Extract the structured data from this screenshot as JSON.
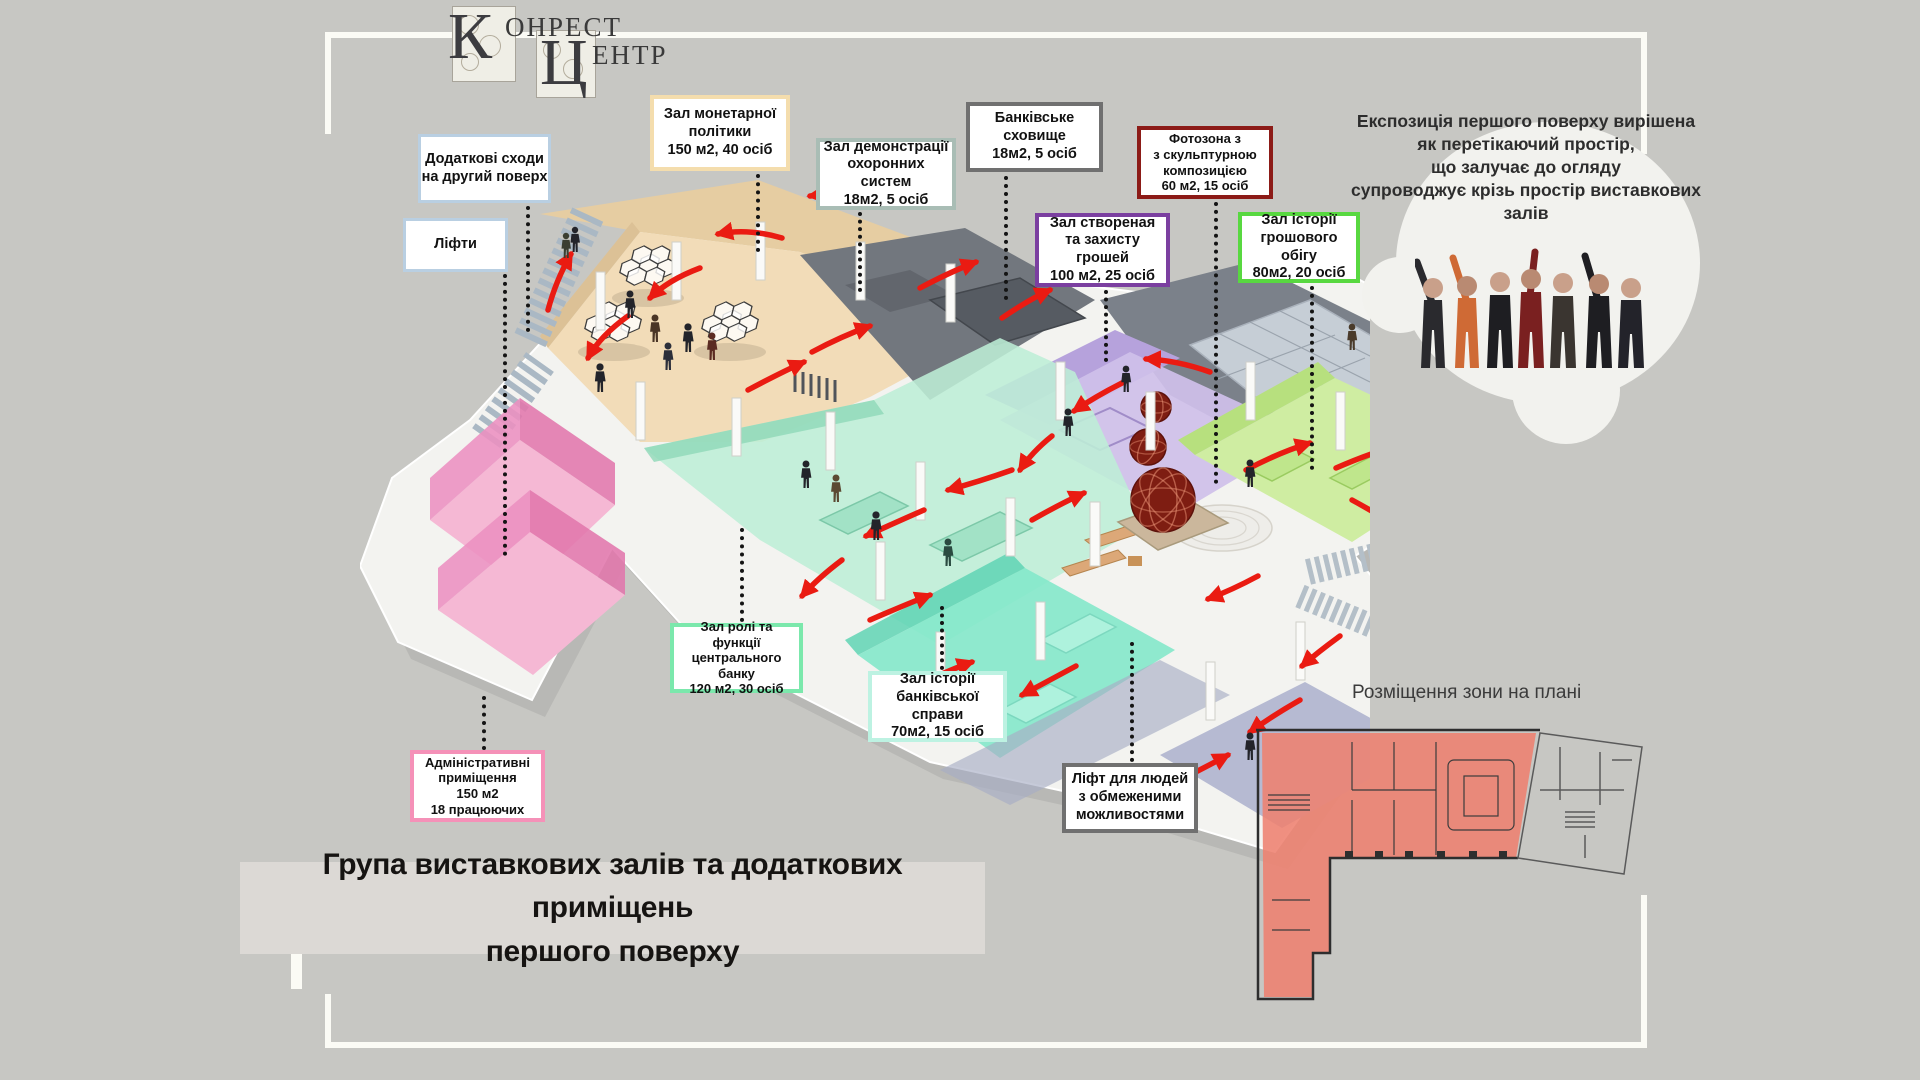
{
  "background_color": "#c7c7c3",
  "logo": {
    "big_k": "К",
    "word_top": "ОНРЕСТ",
    "big_ts": "Ц",
    "word_bottom": "ЕНТР"
  },
  "description": "Експозиція першого поверху вирішена\nяк перетікаючий простір,\nщо залучає до огляду\nсупроводжує крізь простір виставкових\nзалів",
  "plan_section_label": "Розміщення зони на плані",
  "title": "Група виставкових залів та додаткових приміщень\nпершого поверху",
  "callouts": {
    "extra_stairs": {
      "text": "Додаткові сходи\nна другий поверх",
      "border": "#b9cfe2"
    },
    "lifts": {
      "text": "Ліфти",
      "border": "#b9cfe2"
    },
    "monetary_hall": {
      "text": "Зал монетарної\nполітики\n150 м2, 40 осіб",
      "border": "#f4ddad"
    },
    "security_hall": {
      "text": "Зал демонстрації\nохоронних систем\n18м2, 5 осіб",
      "border": "#a9bdb5"
    },
    "bank_vault": {
      "text": "Банківське\nсховище\n18м2, 5 осіб",
      "border": "#707070"
    },
    "photo_zone": {
      "text": "Фотозона з\nз скульптурною\nкомпозицією\n60 м2, 15 осіб",
      "border": "#8c1b17"
    },
    "money_creation_hall": {
      "text": "Зал створеная\nта захисту грошей\n100 м2, 25 осіб",
      "border": "#7b3fa0"
    },
    "money_circulation_hall": {
      "text": "Зал історії\nгрошового обігу\n80м2, 20 осіб",
      "border": "#58d840"
    },
    "central_bank_hall": {
      "text": "Зал ролі та\nфункції\nцентрального банку\n120 м2, 30 осіб",
      "border": "#7be8ac"
    },
    "banking_history_hall": {
      "text": "Зал історії\nбанківської справи\n70м2, 15 осіб",
      "border": "#bdf2e2"
    },
    "admin_rooms": {
      "text": "Адміністративні\nприміщення\n150 м2\n18 працюючих",
      "border": "#f591b8"
    },
    "accessible_lift": {
      "text": "Ліфт для людей\nз обмеженими\nможливостями",
      "border": "#707070"
    }
  },
  "zone_colors": {
    "monetary_tan": "#f2dcb8",
    "central_bank_mint": "#bdeed6",
    "banking_history_teal": "#84e8ca",
    "money_creation_purple": "#cfc0ea",
    "money_circulation_green": "#cfeda2",
    "admin_pink": "#f2a0c6",
    "vault_gray": "#72777e",
    "flow_arrow_red": "#ea1b12",
    "sculpture_dark_red": "#7e1d12",
    "plan_highlight_red": "#ee8170"
  }
}
